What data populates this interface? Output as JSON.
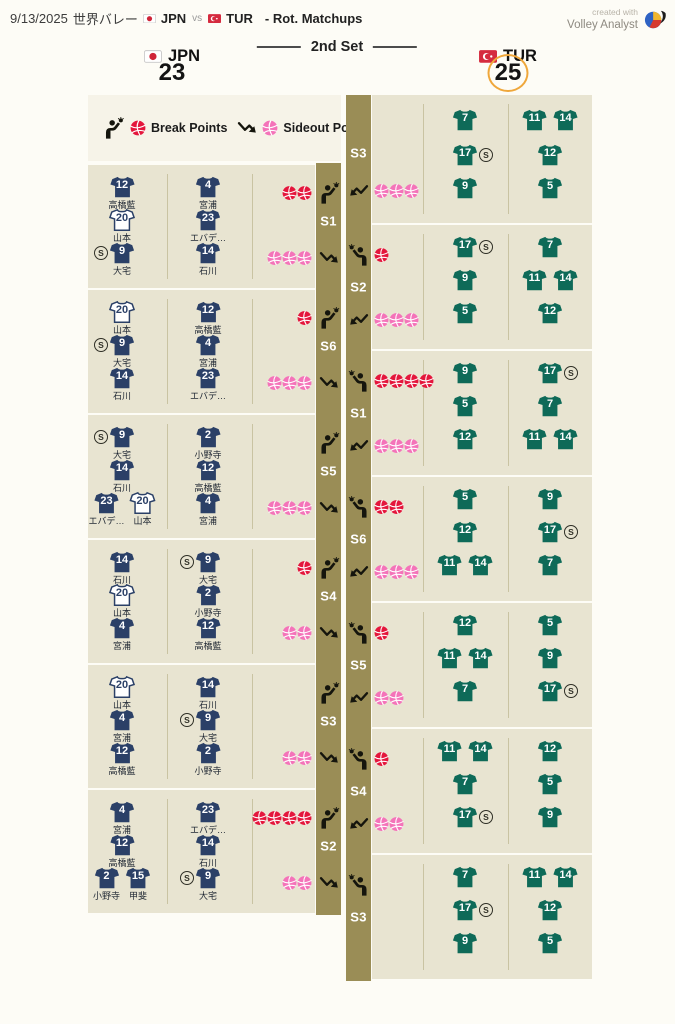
{
  "header": {
    "date": "9/13/2025",
    "event": "世界バレー",
    "team1": "JPN",
    "vs": "vs",
    "team2": "TUR",
    "suffix": "- Rot. Matchups",
    "credit_top": "created with",
    "credit_bottom": "Volley Analyst"
  },
  "scoreboard": {
    "left_team": "JPN",
    "left_score": "23",
    "set_label": "2nd Set",
    "right_team": "TUR",
    "right_score": "25"
  },
  "legend": {
    "break_label": "Break Points",
    "sideout_label": "Sideout Points"
  },
  "colors": {
    "jpn_jersey": "#2b4067",
    "tur_jersey": "#0e6a58",
    "break_ball": "#e4163c",
    "sideout_ball": "#f473b9",
    "strip": "#9a8d56",
    "block_bg": "#e8e4d1",
    "legend_bg": "#f6f3e8",
    "icon_black": "#15150d",
    "score_ring": "#efa73b"
  },
  "jpn_blocks": [
    {
      "rotation": "S1",
      "break_points": 2,
      "sideout_points": 3,
      "col1": [
        [
          {
            "n": "12",
            "name": "高橋藍"
          }
        ],
        [
          {
            "n": "20",
            "name": "山本",
            "w": true
          }
        ],
        [
          {
            "n": "9",
            "name": "大宅",
            "s": true
          }
        ]
      ],
      "col2": [
        [
          {
            "n": "4",
            "name": "宮浦"
          }
        ],
        [
          {
            "n": "23",
            "name": "エバデ…"
          }
        ],
        [
          {
            "n": "14",
            "name": "石川"
          }
        ]
      ]
    },
    {
      "rotation": "S6",
      "break_points": 1,
      "sideout_points": 3,
      "col1": [
        [
          {
            "n": "20",
            "name": "山本",
            "w": true
          }
        ],
        [
          {
            "n": "9",
            "name": "大宅",
            "s": true
          }
        ],
        [
          {
            "n": "14",
            "name": "石川"
          }
        ]
      ],
      "col2": [
        [
          {
            "n": "12",
            "name": "高橋藍"
          }
        ],
        [
          {
            "n": "4",
            "name": "宮浦"
          }
        ],
        [
          {
            "n": "23",
            "name": "エバデ…"
          }
        ]
      ]
    },
    {
      "rotation": "S5",
      "break_points": 0,
      "sideout_points": 3,
      "col1": [
        [
          {
            "n": "9",
            "name": "大宅",
            "s": true
          }
        ],
        [
          {
            "n": "14",
            "name": "石川"
          }
        ],
        [
          {
            "n": "23",
            "name": "エバデ…"
          },
          {
            "n": "20",
            "name": "山本",
            "w": true
          }
        ]
      ],
      "col2": [
        [
          {
            "n": "2",
            "name": "小野寺"
          }
        ],
        [
          {
            "n": "12",
            "name": "高橋藍"
          }
        ],
        [
          {
            "n": "4",
            "name": "宮浦"
          }
        ]
      ]
    },
    {
      "rotation": "S4",
      "break_points": 1,
      "sideout_points": 2,
      "col1": [
        [
          {
            "n": "14",
            "name": "石川"
          }
        ],
        [
          {
            "n": "20",
            "name": "山本",
            "w": true
          }
        ],
        [
          {
            "n": "4",
            "name": "宮浦"
          }
        ]
      ],
      "col2": [
        [
          {
            "n": "9",
            "name": "大宅",
            "s": true
          }
        ],
        [
          {
            "n": "2",
            "name": "小野寺"
          }
        ],
        [
          {
            "n": "12",
            "name": "高橋藍"
          }
        ]
      ]
    },
    {
      "rotation": "S3",
      "break_points": 0,
      "sideout_points": 2,
      "col1": [
        [
          {
            "n": "20",
            "name": "山本",
            "w": true
          }
        ],
        [
          {
            "n": "4",
            "name": "宮浦"
          }
        ],
        [
          {
            "n": "12",
            "name": "高橋藍"
          }
        ]
      ],
      "col2": [
        [
          {
            "n": "14",
            "name": "石川"
          }
        ],
        [
          {
            "n": "9",
            "name": "大宅",
            "s": true
          }
        ],
        [
          {
            "n": "2",
            "name": "小野寺"
          }
        ]
      ]
    },
    {
      "rotation": "S2",
      "break_points": 4,
      "sideout_points": 2,
      "col1": [
        [
          {
            "n": "4",
            "name": "宮浦"
          }
        ],
        [
          {
            "n": "12",
            "name": "高橋藍"
          }
        ],
        [
          {
            "n": "2",
            "name": "小野寺"
          },
          {
            "n": "15",
            "name": "甲斐"
          }
        ]
      ],
      "col2": [
        [
          {
            "n": "23",
            "name": "エバデ…"
          }
        ],
        [
          {
            "n": "14",
            "name": "石川"
          }
        ],
        [
          {
            "n": "9",
            "name": "大宅",
            "s": true
          }
        ]
      ]
    }
  ],
  "tur_blocks": [
    {
      "rotation": "S3",
      "has_serve": false,
      "has_receive": true,
      "break_points": 0,
      "sideout_points": 3,
      "col1": [
        [
          {
            "n": "7"
          }
        ],
        [
          {
            "n": "17",
            "s": true
          }
        ],
        [
          {
            "n": "9"
          }
        ]
      ],
      "col2": [
        [
          {
            "n": "11"
          },
          {
            "n": "14"
          }
        ],
        [
          {
            "n": "12"
          }
        ],
        [
          {
            "n": "5"
          }
        ]
      ]
    },
    {
      "rotation": "S2",
      "has_serve": true,
      "has_receive": true,
      "break_points": 1,
      "sideout_points": 3,
      "col1": [
        [
          {
            "n": "17",
            "s": true
          }
        ],
        [
          {
            "n": "9"
          }
        ],
        [
          {
            "n": "5"
          }
        ]
      ],
      "col2": [
        [
          {
            "n": "7"
          }
        ],
        [
          {
            "n": "11"
          },
          {
            "n": "14"
          }
        ],
        [
          {
            "n": "12"
          }
        ]
      ]
    },
    {
      "rotation": "S1",
      "has_serve": true,
      "has_receive": true,
      "break_points": 4,
      "sideout_points": 3,
      "col1": [
        [
          {
            "n": "9"
          }
        ],
        [
          {
            "n": "5"
          }
        ],
        [
          {
            "n": "12"
          }
        ]
      ],
      "col2": [
        [
          {
            "n": "17",
            "s": true
          }
        ],
        [
          {
            "n": "7"
          }
        ],
        [
          {
            "n": "11"
          },
          {
            "n": "14"
          }
        ]
      ]
    },
    {
      "rotation": "S6",
      "has_serve": true,
      "has_receive": true,
      "break_points": 2,
      "sideout_points": 3,
      "col1": [
        [
          {
            "n": "5"
          }
        ],
        [
          {
            "n": "12"
          }
        ],
        [
          {
            "n": "11"
          },
          {
            "n": "14"
          }
        ]
      ],
      "col2": [
        [
          {
            "n": "9"
          }
        ],
        [
          {
            "n": "17",
            "s": true
          }
        ],
        [
          {
            "n": "7"
          }
        ]
      ]
    },
    {
      "rotation": "S5",
      "has_serve": true,
      "has_receive": true,
      "break_points": 1,
      "sideout_points": 2,
      "col1": [
        [
          {
            "n": "12"
          }
        ],
        [
          {
            "n": "11"
          },
          {
            "n": "14"
          }
        ],
        [
          {
            "n": "7"
          }
        ]
      ],
      "col2": [
        [
          {
            "n": "5"
          }
        ],
        [
          {
            "n": "9"
          }
        ],
        [
          {
            "n": "17",
            "s": true
          }
        ]
      ]
    },
    {
      "rotation": "S4",
      "has_serve": true,
      "has_receive": true,
      "break_points": 1,
      "sideout_points": 2,
      "col1": [
        [
          {
            "n": "11"
          },
          {
            "n": "14"
          }
        ],
        [
          {
            "n": "7"
          }
        ],
        [
          {
            "n": "17",
            "s": true
          }
        ]
      ],
      "col2": [
        [
          {
            "n": "12"
          }
        ],
        [
          {
            "n": "5"
          }
        ],
        [
          {
            "n": "9"
          }
        ]
      ]
    },
    {
      "rotation": "S3",
      "has_serve": true,
      "has_receive": false,
      "break_points": 0,
      "sideout_points": 0,
      "col1": [
        [
          {
            "n": "7"
          }
        ],
        [
          {
            "n": "17",
            "s": true
          }
        ],
        [
          {
            "n": "9"
          }
        ]
      ],
      "col2": [
        [
          {
            "n": "11"
          },
          {
            "n": "14"
          }
        ],
        [
          {
            "n": "12"
          }
        ],
        [
          {
            "n": "5"
          }
        ]
      ]
    }
  ]
}
